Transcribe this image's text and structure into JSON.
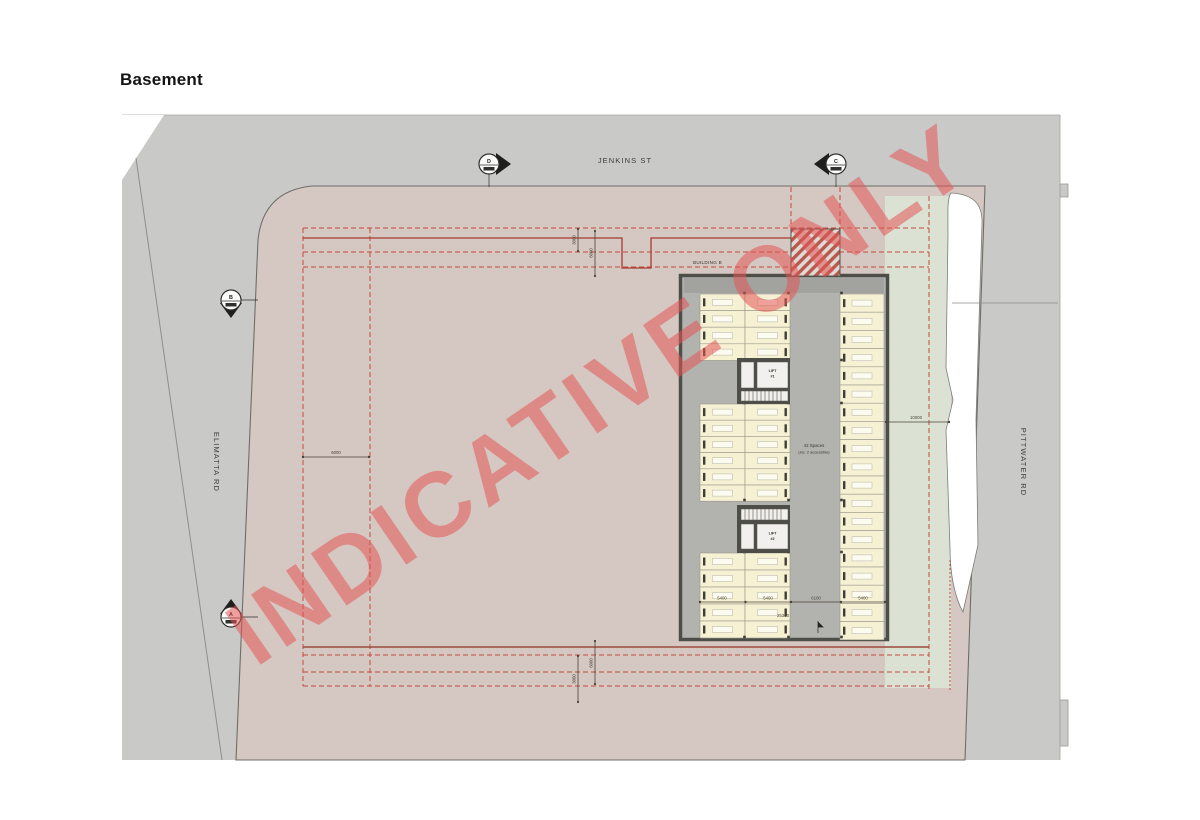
{
  "page": {
    "title": "Basement"
  },
  "watermark": {
    "text": "INDICATIVE ONLY"
  },
  "roads": {
    "top": {
      "label": "JENKINS ST"
    },
    "left": {
      "label": "ELIMATTA RD"
    },
    "right": {
      "label": "PITTWATER RD"
    }
  },
  "markers": {
    "a": "A",
    "b": "B",
    "c": "C",
    "d": "D"
  },
  "building": {
    "label": "BUILDING B",
    "lift1_line1": "LIFT",
    "lift1_line2": "#1",
    "lift2_line1": "LIFT",
    "lift2_line2": "#2",
    "parking_note_line1": "42 Spaces",
    "parking_note_line2": "(inc. 2 accessible)"
  },
  "dimensions": {
    "west_setback": "6000",
    "east_strip": "10000",
    "north_a": "3000",
    "north_b": "6000",
    "south_a": "6000",
    "south_b": "3000",
    "stall_left_1": "5400",
    "stall_left_2": "5400",
    "aisle": "6100",
    "stall_right": "5400",
    "total_width": "25300"
  },
  "colors": {
    "road": "#c9c9c8",
    "site": "#d5c8c2",
    "landscape": "#dbe2d3",
    "verge": "#ffffff",
    "floor": "#b2b2af",
    "floor_dark": "#a2a29e",
    "wall": "#4e4e48",
    "bay": "#f7f1d3",
    "bay_mark": "#fdfbf0",
    "bay_stroke": "#98988c",
    "tick": "#3f3f39",
    "red_dash": "#c64a3c",
    "red_solid": "#a83a30",
    "dim": "#4a4238",
    "watermark": "rgba(227,85,85,0.55)"
  },
  "plan_layout": {
    "bay_groups": [
      {
        "x": 700,
        "y": 294,
        "cols": 2,
        "colW": 45,
        "rows": 4,
        "rowH": 16.6
      },
      {
        "x": 700,
        "y": 404,
        "cols": 2,
        "colW": 45,
        "rows": 6,
        "rowH": 16.2
      },
      {
        "x": 700,
        "y": 553,
        "cols": 2,
        "colW": 45,
        "rows": 5,
        "rowH": 17.0
      },
      {
        "x": 840,
        "y": 294,
        "cols": 1,
        "colW": 44,
        "rows": 19,
        "rowH": 18.2
      }
    ]
  }
}
